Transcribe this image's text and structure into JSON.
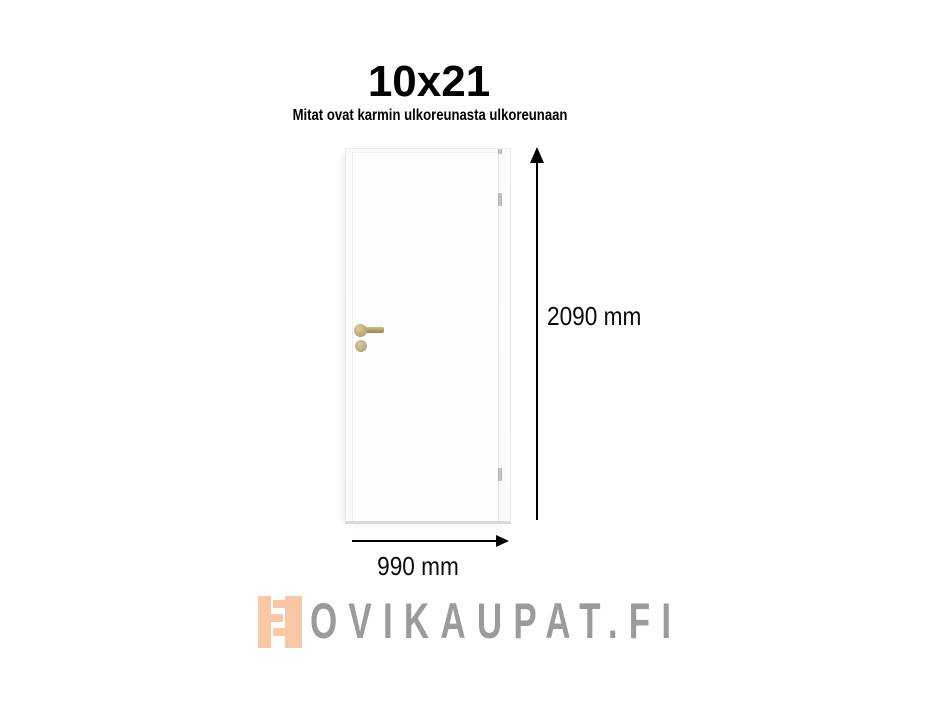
{
  "page": {
    "background_color": "#ffffff"
  },
  "header": {
    "title": "10x21",
    "subtitle": "Mitat ovat karmin ulkoreunasta ulkoreunaan"
  },
  "diagram": {
    "door": {
      "kind": "white interior door with frame",
      "face_color": "#fdfdfd",
      "edge_color": "#e9e9e9",
      "handle_color": "#b3a05f",
      "hinge_color": "#b0b0b0",
      "handle_side": "left",
      "hinge_side": "right",
      "visible_hinges": 3
    },
    "height": {
      "label": "2090 mm",
      "arrow_direction": "up"
    },
    "width": {
      "label": "990 mm",
      "arrow_direction": "right"
    },
    "arrow_color": "#000000"
  },
  "footer": {
    "logo": {
      "text": "OVIKAUPAT.FI",
      "text_color": "#9b9b9b",
      "icon": "door-hinge-icon",
      "icon_color": "#f9c7a3"
    }
  }
}
